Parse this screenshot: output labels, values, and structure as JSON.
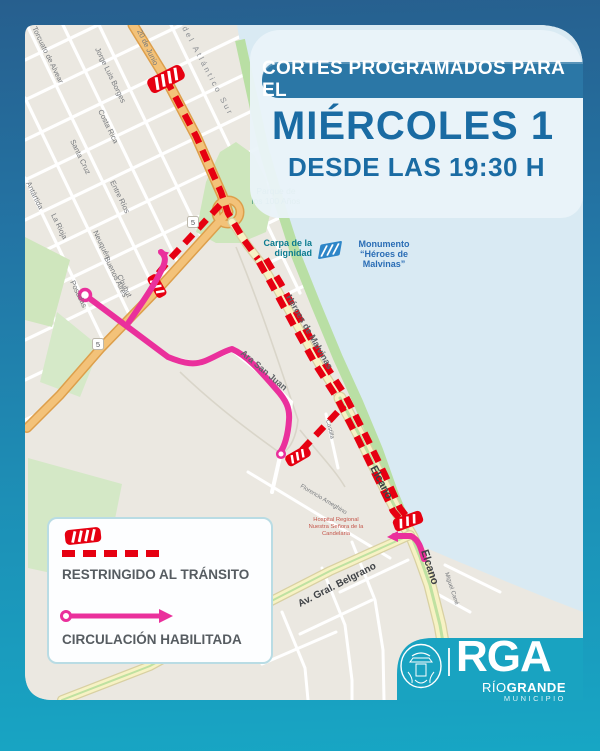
{
  "header": {
    "banner": "CORTES PROGRAMADOS PARA EL",
    "day": "MIÉRCOLES 1",
    "time": "DESDE LAS 19:30 H"
  },
  "legend": {
    "restricted": "RESTRINGIDO AL TRÁNSITO",
    "enabled": "CIRCULACIÓN HABILITADA"
  },
  "logo": {
    "acronym": "RGA",
    "city_rio": "RÍO",
    "city_grande": "GRANDE",
    "subtitle": "MUNICIPIO"
  },
  "map": {
    "route_shield": "5",
    "streets": [
      {
        "label": "Torcuato de Alvear"
      },
      {
        "label": "Jorge Luis Borges"
      },
      {
        "label": "20 de Junio"
      },
      {
        "label": "del Atlántico Sur"
      },
      {
        "label": "Costa Rica"
      },
      {
        "label": "Santa Cruz"
      },
      {
        "label": "Entre Ríos"
      },
      {
        "label": "La Rioja"
      },
      {
        "label": "Antártida"
      },
      {
        "label": "Neuquén"
      },
      {
        "label": "Buenos Aires"
      },
      {
        "label": "Chubut"
      },
      {
        "label": "Posadas"
      },
      {
        "label": "Ara San Juan"
      },
      {
        "label": "Héroes de Malvinas"
      },
      {
        "label": "Elcano"
      },
      {
        "label": "Elcano"
      },
      {
        "label": "Av. Gral. Belgrano"
      },
      {
        "label": "Castilla"
      },
      {
        "label": "Florencio Ameghino"
      },
      {
        "label": "Miguel Cané"
      }
    ],
    "pois": {
      "carpa_l1": "Carpa de la",
      "carpa_l2": "dignidad",
      "mon_l1": "Monumento",
      "mon_l2": "“Héroes de",
      "mon_l3": "Malvinas”",
      "parque_l1": "Parque de",
      "parque_l2": "los 100 Años",
      "hosp_l1": "Hospital Regional",
      "hosp_l2": "Nuestra Señora de la",
      "hosp_l3": "Candelaria"
    }
  },
  "colors": {
    "frame_teal": "#18a5c4",
    "banner_blue": "#2b77a6",
    "title_blue": "#1a6ba3",
    "restricted_red": "#e60011",
    "enabled_pink": "#ea309c",
    "water": "#d9eaf3"
  }
}
